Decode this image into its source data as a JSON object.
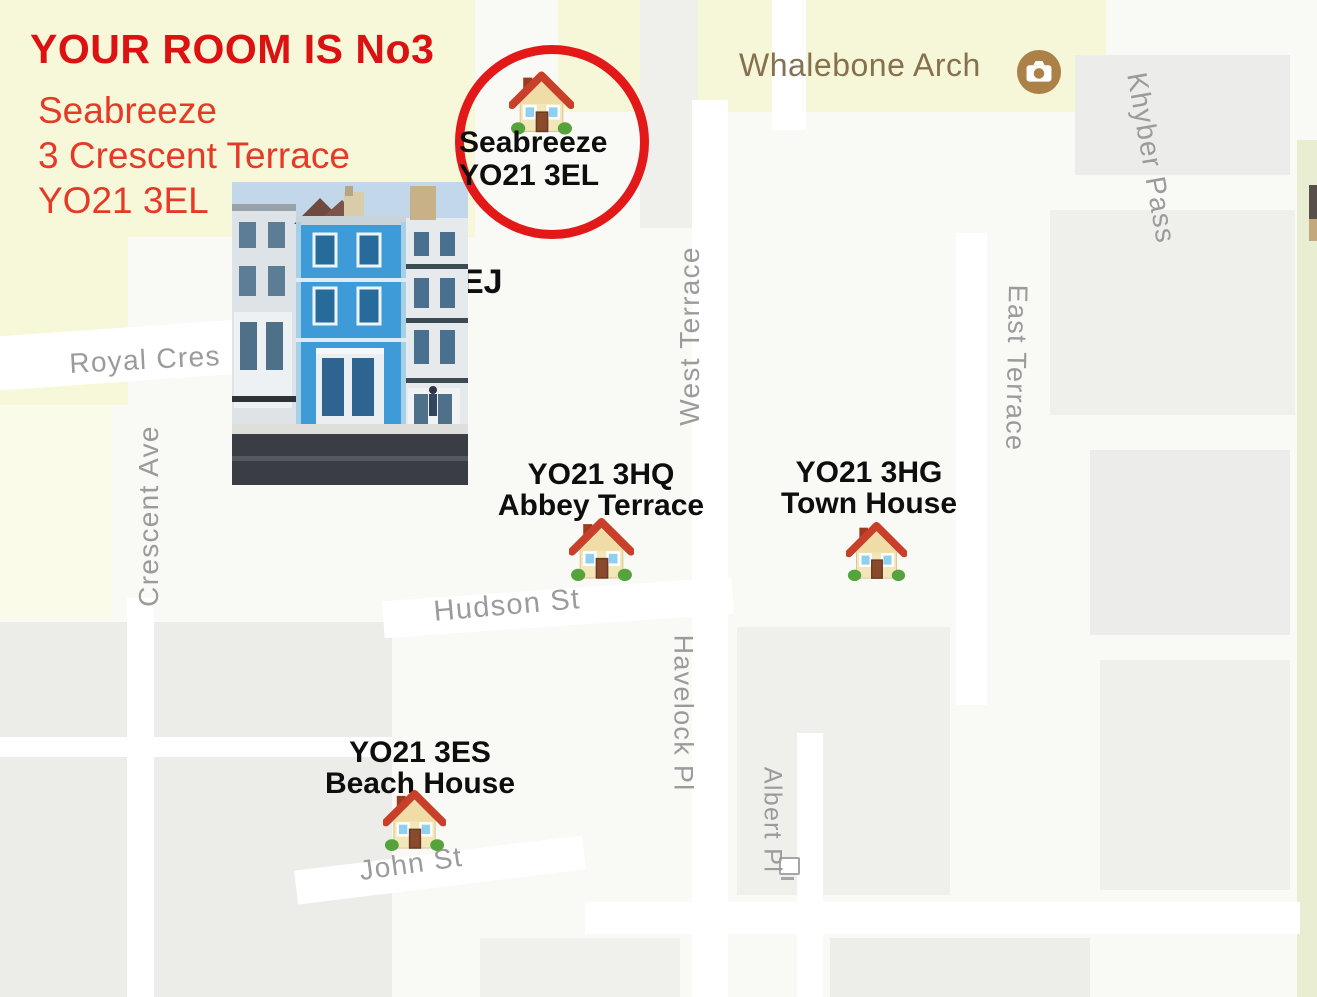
{
  "colors": {
    "annotation_red": "#dc1212",
    "address_red": "#e63a28",
    "circle_red": "#e31818",
    "street_gray": "#9b9b9b",
    "poi_brown": "#86704e",
    "label_black": "#0e0e0e",
    "map_yellow": "#f7f8da",
    "map_green_edge": "#e9eed2"
  },
  "title_block": {
    "heading": "YOUR ROOM IS No3",
    "address_lines": [
      "Seabreeze",
      "3 Crescent Terrace",
      "YO21 3EL"
    ]
  },
  "seabreeze_marker": {
    "name": "Seabreeze",
    "postcode": "YO21 3EL"
  },
  "partial_postcode_label": "EJ",
  "poi": {
    "whalebone_arch": "Whalebone Arch"
  },
  "streets": {
    "royal_cres": "Royal Cres",
    "crescent_ave": "Crescent Ave",
    "west_terrace": "West Terrace",
    "east_terrace": "East Terrace",
    "khyber_pass": "Khyber Pass",
    "hudson_st": "Hudson St",
    "havelock_pl": "Havelock Pl",
    "albert_pl": "Albert Pl",
    "john_st": "John St"
  },
  "properties": {
    "abbey_terrace": {
      "postcode": "YO21 3HQ",
      "name": "Abbey Terrace"
    },
    "town_house": {
      "postcode": "YO21 3HG",
      "name": "Town House"
    },
    "beach_house": {
      "postcode": "YO21 3ES",
      "name": "Beach House"
    }
  }
}
